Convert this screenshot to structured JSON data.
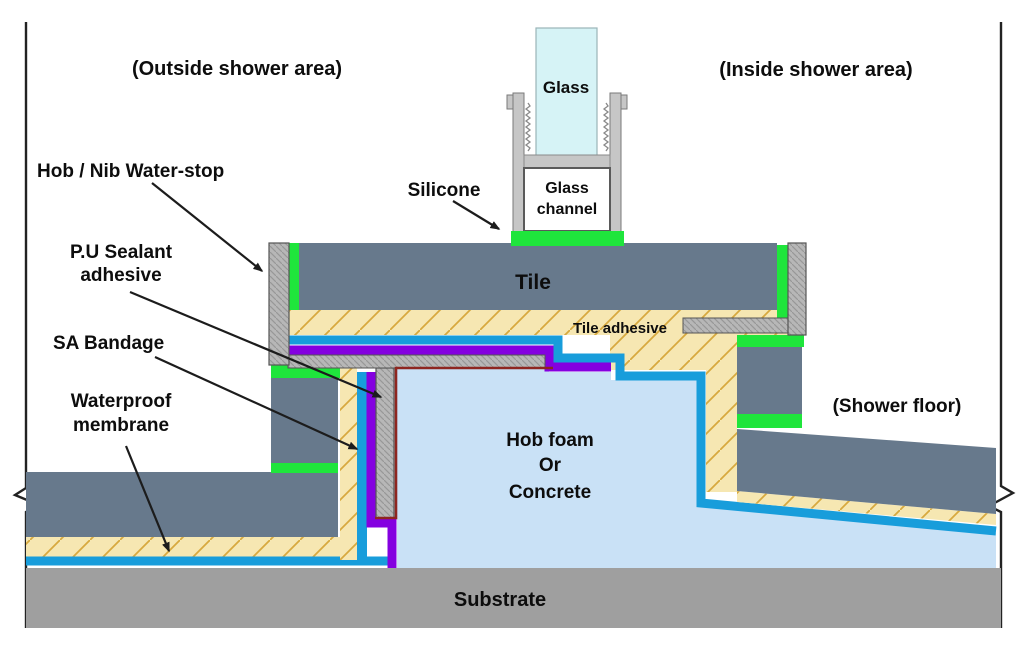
{
  "title": "Hob / Nib water-stop shower construction detail",
  "areas": {
    "outside": "(Outside shower area)",
    "inside": "(Inside shower area)",
    "shower_floor": "(Shower floor)"
  },
  "labels": {
    "glass": "Glass",
    "silicone": "Silicone",
    "glass_channel_line1": "Glass",
    "glass_channel_line2": "channel",
    "hob_nib_water_stop": "Hob / Nib Water-stop",
    "pu_sealant_line1": "P.U Sealant",
    "pu_sealant_line2": "adhesive",
    "sa_bandage": "SA Bandage",
    "waterproof_line1": "Waterproof",
    "waterproof_line2": "membrane",
    "tile": "Tile",
    "tile_adhesive": "Tile adhesive",
    "hob_foam_line1": "Hob foam",
    "hob_foam_line2": "Or",
    "hob_foam_line3": "Concrete",
    "substrate": "Substrate"
  },
  "colors": {
    "tile": "#67798c",
    "tile_adhesive": "#f6e7b2",
    "waterproof_membrane": "#189ddb",
    "sa_bandage": "#8400e0",
    "pu_sealant": "#8e2620",
    "silicone": "#1fe53c",
    "water_stop": "#b7b7b7",
    "hob_foam": "#c9e1f6",
    "substrate": "#9f9f9f",
    "glass": "#d6f3f6",
    "glass_channel": "#c6c6c6",
    "tile_text": "#141e2a"
  }
}
